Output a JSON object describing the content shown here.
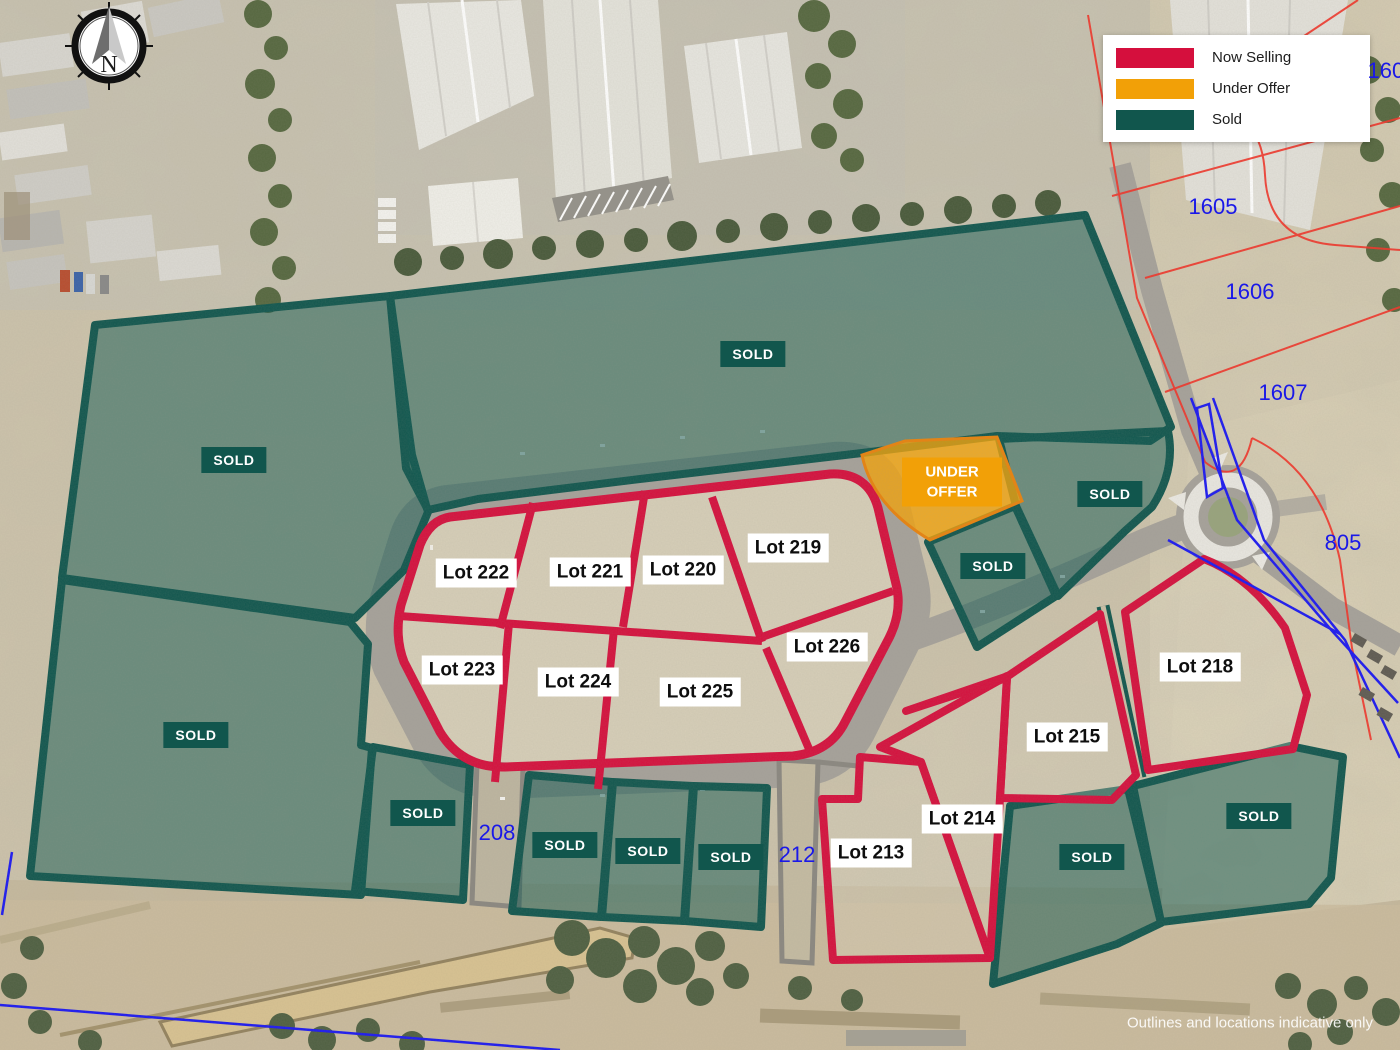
{
  "map": {
    "compass": {
      "letter": "N"
    },
    "legend": {
      "items": [
        {
          "label": "Now Selling",
          "color": "#D50F3D"
        },
        {
          "label": "Under Offer",
          "color": "#F2A007"
        },
        {
          "label": "Sold",
          "color": "#11564D"
        }
      ]
    },
    "status_colors": {
      "now_selling": "#D50F3D",
      "under_offer": "#F2A007",
      "sold": "#11564D"
    },
    "lots": [
      {
        "label": "Lot 222",
        "x": 476,
        "y": 573
      },
      {
        "label": "Lot 221",
        "x": 590,
        "y": 572
      },
      {
        "label": "Lot 220",
        "x": 683,
        "y": 570
      },
      {
        "label": "Lot 219",
        "x": 788,
        "y": 548
      },
      {
        "label": "Lot 226",
        "x": 827,
        "y": 647
      },
      {
        "label": "Lot 223",
        "x": 462,
        "y": 670
      },
      {
        "label": "Lot 224",
        "x": 578,
        "y": 682
      },
      {
        "label": "Lot 225",
        "x": 700,
        "y": 692
      },
      {
        "label": "Lot 218",
        "x": 1200,
        "y": 667
      },
      {
        "label": "Lot 215",
        "x": 1067,
        "y": 737
      },
      {
        "label": "Lot 214",
        "x": 962,
        "y": 819
      },
      {
        "label": "Lot 213",
        "x": 871,
        "y": 853
      }
    ],
    "sold_labels": [
      {
        "label": "SOLD",
        "x": 234,
        "y": 460
      },
      {
        "label": "SOLD",
        "x": 753,
        "y": 354
      },
      {
        "label": "SOLD",
        "x": 1110,
        "y": 494
      },
      {
        "label": "SOLD",
        "x": 993,
        "y": 566
      },
      {
        "label": "SOLD",
        "x": 196,
        "y": 735
      },
      {
        "label": "SOLD",
        "x": 423,
        "y": 813
      },
      {
        "label": "SOLD",
        "x": 565,
        "y": 845
      },
      {
        "label": "SOLD",
        "x": 648,
        "y": 851
      },
      {
        "label": "SOLD",
        "x": 731,
        "y": 857
      },
      {
        "label": "SOLD",
        "x": 1092,
        "y": 857
      },
      {
        "label": "SOLD",
        "x": 1259,
        "y": 816
      }
    ],
    "under_offer": {
      "label": "UNDER OFFER",
      "x": 952,
      "y": 482
    },
    "cadastral_numbers": [
      {
        "label": "1603",
        "x": 1392,
        "y": 71
      },
      {
        "label": "1605",
        "x": 1213,
        "y": 207
      },
      {
        "label": "1606",
        "x": 1250,
        "y": 292
      },
      {
        "label": "1607",
        "x": 1283,
        "y": 393
      },
      {
        "label": "805",
        "x": 1343,
        "y": 543
      },
      {
        "label": "208",
        "x": 497,
        "y": 833
      },
      {
        "label": "212",
        "x": 797,
        "y": 855
      }
    ],
    "disclaimer": {
      "text": "Outlines and locations indicative only",
      "x": 1250,
      "y": 1023
    }
  }
}
